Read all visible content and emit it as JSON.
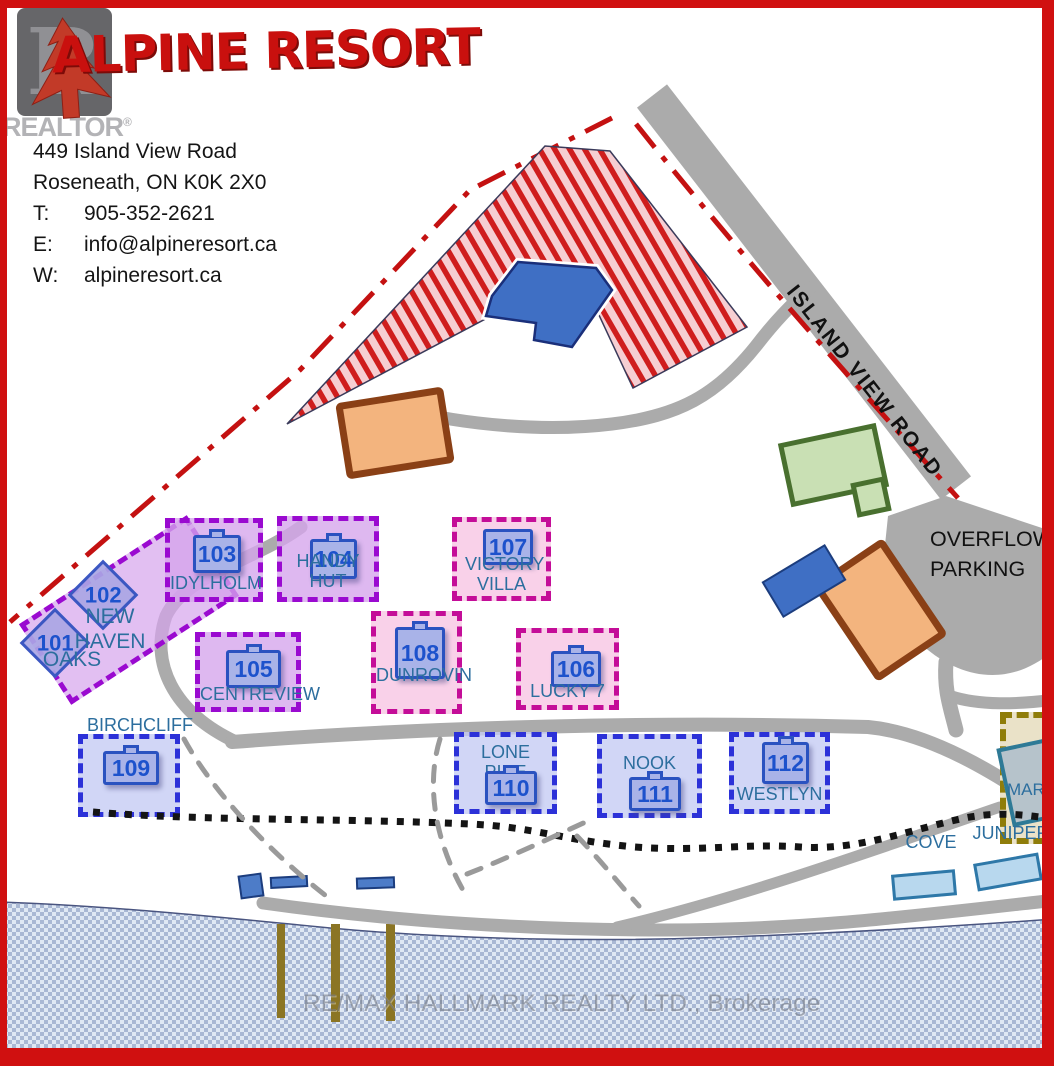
{
  "realtor_watermark": {
    "letter": "R",
    "label": "REALTOR",
    "reg": "®"
  },
  "header": {
    "title": "ALPINE RESORT",
    "address_line1": "449 Island View Road",
    "address_line2": "Roseneath, ON K0K 2X0",
    "rows": [
      {
        "label": "T:",
        "value": "905-352-2621"
      },
      {
        "label": "E:",
        "value": "info@alpineresort.ca"
      },
      {
        "label": "W:",
        "value": "alpineresort.ca"
      }
    ]
  },
  "map": {
    "road_label": "ISLAND VIEW ROAD",
    "overflow_line1": "OVERFLOW",
    "overflow_line2": "PARKING",
    "marina_label": "MARINA",
    "cove_label": "COVE",
    "juniper_label": "JUNIPER",
    "watermark": "RE/MAX HALLMARK REALTY LTD., Brokerage",
    "colors": {
      "frame_red": "#d01010",
      "boundary_red": "#c41111",
      "road_gray": "#ababab",
      "stripe_red": "#cf1d1d",
      "stripe_pink": "#f6ced2",
      "lodge_blue": "#3f6fc4",
      "building_orange": "#f3b47e",
      "building_orange_border": "#8a4016",
      "building_green": "#c9e0b4",
      "cabin_purple_border": "#9a0ad0",
      "cabin_pink_border": "#c40d98",
      "cabin_blue_border": "#2c31d8",
      "badge_blue": "#1d52cc",
      "name_teal": "#2c6e9e",
      "water_light": "#dfe8f4",
      "water_dark": "#a9b8d4",
      "dock_brown": "#8b7524",
      "marina_border": "#8f7d0a"
    }
  },
  "cabins": [
    {
      "number": "101",
      "name": "OAKS"
    },
    {
      "number": "102",
      "name": "NEW HAVEN"
    },
    {
      "number": "103",
      "name": "IDYLHOLM"
    },
    {
      "number": "104",
      "name": "HANDY HUT"
    },
    {
      "number": "105",
      "name": "CENTREVIEW"
    },
    {
      "number": "106",
      "name": "LUCKY 7"
    },
    {
      "number": "107",
      "name": "VICTORY VILLA"
    },
    {
      "number": "108",
      "name": "DUNROVIN"
    },
    {
      "number": "109",
      "name": "BIRCHCLIFF"
    },
    {
      "number": "110",
      "name": "LONE PINE"
    },
    {
      "number": "111",
      "name": "NOOK"
    },
    {
      "number": "112",
      "name": "WESTLYN"
    }
  ]
}
